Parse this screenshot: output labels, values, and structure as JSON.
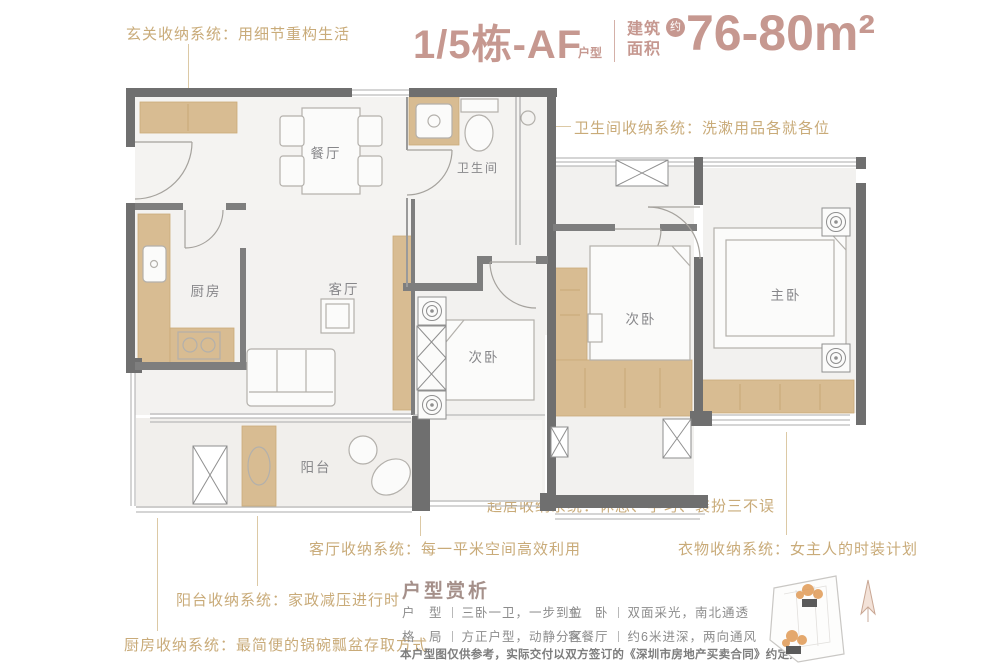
{
  "header": {
    "unit_title": "1/5栋-AF",
    "unit_suffix": "户型",
    "area_label_line1": "建筑",
    "area_label_line2": "面积",
    "area_approx": "约",
    "area_value": "76-80m²",
    "accent_color": "#c69890"
  },
  "annotations": {
    "color": "#c9ab79",
    "entry": "玄关收纳系统：用细节重构生活",
    "bathroom": "卫生间收纳系统：洗漱用品各就各位",
    "bedroom": "起居收纳系统：休息、学习、装扮三不误",
    "living": "客厅收纳系统：每一平米空间高效利用",
    "wardrobe": "衣物收纳系统：女主人的时装计划",
    "balcony": "阳台收纳系统：家政减压进行时",
    "kitchen": "厨房收纳系统：最简便的锅碗瓢盆存取方式"
  },
  "floorplan": {
    "wall_color": "#6f6f6f",
    "cabinet_color": "#d8bc92",
    "rooms": {
      "dining": "餐厅",
      "bathroom": "卫生间",
      "kitchen": "厨房",
      "living": "客厅",
      "bedroom2": "次卧",
      "bedroom3": "次卧",
      "master": "主卧",
      "balcony": "阳台"
    }
  },
  "analysis": {
    "title": "户型赏析",
    "items": [
      {
        "label": "户　型",
        "value": "三卧一卫，一步到位"
      },
      {
        "label": "主　卧",
        "value": "双面采光，南北通透"
      },
      {
        "label": "格　局",
        "value": "方正户型，动静分区"
      },
      {
        "label": "客餐厅",
        "value": "约6米进深，两向通风"
      }
    ],
    "disclaimer": "本户型图仅供参考，实际交付以双方签订的《深圳市房地产买卖合同》约定为准。"
  }
}
